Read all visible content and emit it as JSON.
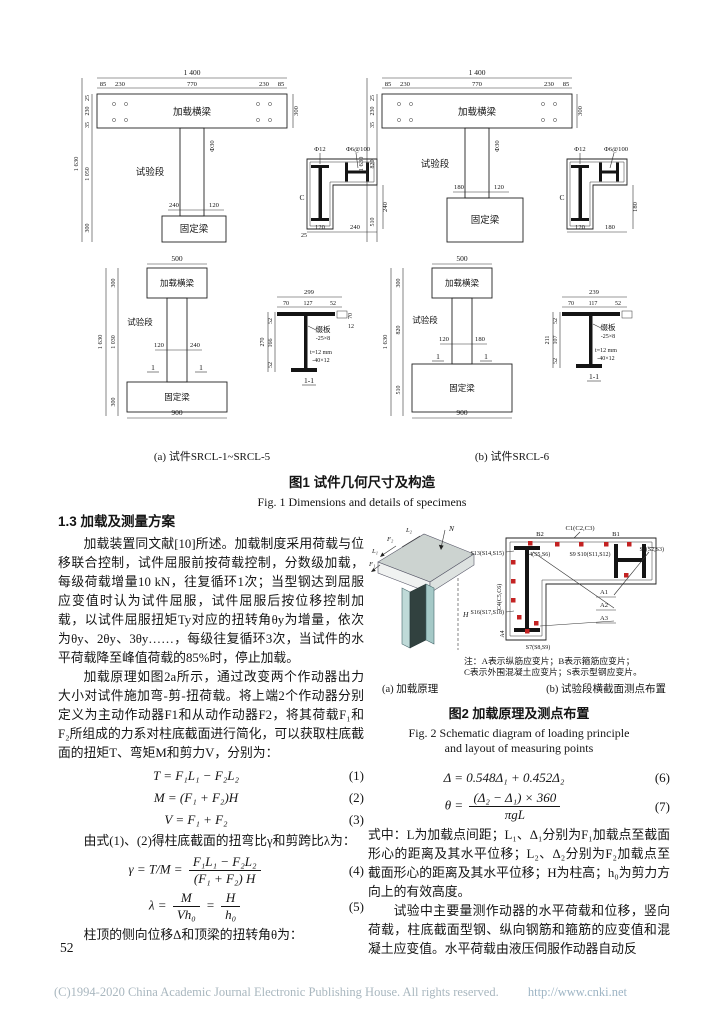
{
  "page": {
    "number": "52"
  },
  "footer": {
    "copyright": "(C)1994-2020 China Academic Journal Electronic Publishing House. All rights reserved.",
    "url": "http://www.cnki.net"
  },
  "figure1": {
    "sub_a": "(a) 试件SRCL-1~SRCL-5",
    "sub_b": "(b) 试件SRCL-6",
    "caption_zh": "图1  试件几何尺寸及构造",
    "caption_en": "Fig. 1  Dimensions and details of specimens",
    "elevA": {
      "w": "1 400",
      "s1": "85",
      "s2": "230",
      "s3": "770",
      "s4": "230",
      "s5": "85",
      "h": "1 630",
      "v1": "25",
      "v2": "230",
      "v3": "35",
      "v4": "1 050",
      "v5": "300",
      "beam": "加载横梁",
      "beam_h": "300",
      "col": "试验段",
      "base": "固定梁",
      "d1": "240",
      "d2": "120",
      "phi": "Φ30"
    },
    "secA": {
      "l1": "Φ12",
      "l2": "Φ6@100",
      "l3": "C",
      "d1": "120",
      "d2": "240",
      "d3": "240",
      "d4": "25"
    },
    "elevB": {
      "w": "1 400",
      "s1": "85",
      "s2": "230",
      "s3": "770",
      "s4": "230",
      "s5": "85",
      "h": "1 630",
      "v1": "25",
      "v2": "230",
      "v3": "35",
      "v4": "820",
      "v5": "510",
      "beam": "加载横梁",
      "beam_h": "300",
      "col": "试验段",
      "base": "固定梁",
      "d1": "180",
      "d2": "120",
      "phi": "Φ30"
    },
    "secB": {
      "l1": "Φ12",
      "l2": "Φ6@100",
      "l3": "C",
      "d1": "120",
      "d2": "180",
      "d3": "180"
    },
    "elevC": {
      "w": "500",
      "h": "1 630",
      "v1": "300",
      "v2": "1 030",
      "v3": "300",
      "beam": "加载横梁",
      "col": "试验段",
      "base": "固定梁",
      "d1": "120",
      "d2": "240",
      "cut": "1",
      "base_w": "900"
    },
    "secC": {
      "w": "299",
      "s1": "70",
      "s2": "127",
      "s3": "52",
      "h": "270",
      "v1": "52",
      "v2": "166",
      "v3": "52",
      "p1": "缀板",
      "p2": "-25×8",
      "p3": "t=12 mm",
      "p4": "-40×12",
      "d1": "70",
      "d2": "12",
      "cut": "1-1"
    },
    "elevD": {
      "w": "500",
      "h": "1 630",
      "v1": "300",
      "v2": "820",
      "v3": "510",
      "beam": "加载横梁",
      "col": "试验段",
      "base": "固定梁",
      "d1": "120",
      "d2": "180",
      "cut": "1",
      "base_w": "900"
    },
    "secD": {
      "w": "239",
      "s1": "70",
      "s2": "117",
      "s3": "52",
      "h": "211",
      "v1": "52",
      "v2": "107",
      "v3": "52",
      "p1": "缀板",
      "p2": "-25×8",
      "p3": "t=12 mm",
      "p4": "-40×12",
      "cut": "1-1"
    }
  },
  "section13": {
    "heading": "1.3  加载及测量方案"
  },
  "paragraphs": {
    "p1": "加载装置同文献[10]所述。加载制度采用荷载与位移联合控制，试件屈服前按荷载控制，分数级加载，每级荷载增量10 kN，往复循环1次；当型钢达到屈服应变值时认为试件屈服，试件屈服后按位移控制加载，以试件屈服扭矩Ty对应的扭转角θy为增量，依次为θy、2θy、3θy……，每级往复循环3次，当试件的水平荷载降至峰值荷载的85%时，停止加载。",
    "p2": "加载原理如图2a所示，通过改变两个作动器出力大小对试件施加弯-剪-扭荷载。将上端2个作动器分别定义为主动作动器F1和从动作动器F2，将其荷载F₁和F₂所组成的力系对柱底截面进行简化，可以获取柱底截面的扭矩T、弯矩M和剪力V，分别为：",
    "p3": "由式(1)、(2)得柱底截面的扭弯比γ和剪跨比λ为：",
    "p4": "柱顶的侧向位移Δ和顶梁的扭转角θ为：",
    "p5": "式中：L为加载点间距；L₁、Δ₁分别为F₁加载点至截面形心的距离及其水平位移；L₂、Δ₂分别为F₂加载点至截面形心的距离及其水平位移；H为柱高；h₀为剪力方向上的有效高度。",
    "p6": "试验中主要量测作动器的水平荷载和位移，竖向荷载，柱底截面型钢、纵向钢筋和箍筋的应变值和混凝土应变值。水平荷载由液压伺服作动器自动反"
  },
  "equations": {
    "eq1": {
      "body": "T = F₁L₁ − F₂L₂",
      "tag": "(1)"
    },
    "eq2": {
      "body": "M = (F₁ + F₂)H",
      "tag": "(2)"
    },
    "eq3": {
      "body": "V = F₁ + F₂",
      "tag": "(3)"
    },
    "eq4": {
      "lhs": "γ = T/M =",
      "top": "F₁L₁ − F₂L₂",
      "bot": "(F₁ + F₂) H",
      "tag": "(4)"
    },
    "eq5": {
      "lhs": "λ =",
      "f1top": "M",
      "f1bot": "Vh₀",
      "mid": "=",
      "f2top": "H",
      "f2bot": "h₀",
      "tag": "(5)"
    },
    "eq6": {
      "body": "Δ = 0.548Δ₁ + 0.452Δ₂",
      "tag": "(6)"
    },
    "eq7": {
      "lhs": "θ =",
      "top": "(Δ₂ − Δ₁) × 360",
      "bot": "πgL",
      "tag": "(7)"
    }
  },
  "figure2": {
    "iso": {
      "l2": "L₂",
      "f2": "F₂",
      "l1": "L₁",
      "f1": "F₁",
      "n": "N",
      "h": "H"
    },
    "sec": {
      "c1": "C1(C2,C3)",
      "b2": "B2",
      "b1": "B1",
      "s4": "S4(S5,S6)",
      "s_mid": "S9 S10(S11,S12)",
      "s1": "S1(S2,S3)",
      "s13": "S13(S14,S15)",
      "c4": "C4(C5,C6)",
      "s16": "S16(S17,S18)",
      "s7": "S7(S8,S9)",
      "a1": "A1",
      "a2": "A2",
      "a3": "A3",
      "a4": "A4"
    },
    "note1": "注：A表示纵筋应变片；B表示箍筋应变片；",
    "note2": "C表示外围混凝土应变片；S表示型钢应变片。",
    "sub_a": "(a) 加载原理",
    "sub_b": "(b) 试验段横截面测点布置",
    "caption_zh": "图2  加载原理及测点布置",
    "caption_en1": "Fig. 2  Schematic diagram of loading principle",
    "caption_en2": "and layout of measuring points"
  }
}
